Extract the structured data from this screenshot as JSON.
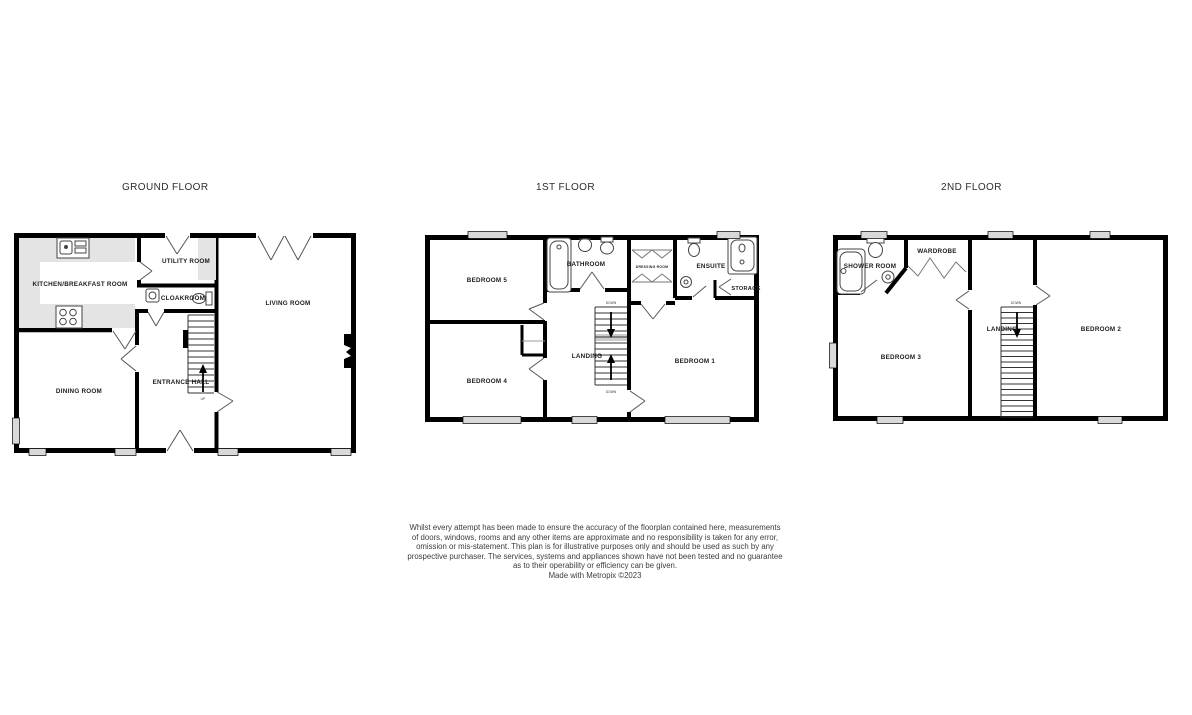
{
  "colors": {
    "wall": "#000000",
    "window_fill": "#d9d9d9",
    "counter_fill": "#e4e4e4",
    "fixture_stroke": "#444444",
    "label_color": "#1c1c1c"
  },
  "floors": [
    {
      "title": "GROUND FLOOR",
      "rooms": [
        {
          "label": "KITCHEN/BREAKFAST ROOM"
        },
        {
          "label": "UTILITY ROOM"
        },
        {
          "label": "CLOAKROOM"
        },
        {
          "label": "LIVING ROOM"
        },
        {
          "label": "DINING ROOM"
        },
        {
          "label": "ENTRANCE HALL"
        }
      ],
      "stair_label": "UP"
    },
    {
      "title": "1ST FLOOR",
      "rooms": [
        {
          "label": "BEDROOM 5"
        },
        {
          "label": "BATHROOM"
        },
        {
          "label": "DRESSING ROOM"
        },
        {
          "label": "ENSUITE"
        },
        {
          "label": "STORAGE"
        },
        {
          "label": "LANDING"
        },
        {
          "label": "BEDROOM 1"
        },
        {
          "label": "BEDROOM 4"
        }
      ],
      "stair_label_top": "DOWN",
      "stair_label_bottom": "DOWN"
    },
    {
      "title": "2ND FLOOR",
      "rooms": [
        {
          "label": "SHOWER ROOM"
        },
        {
          "label": "WARDROBE"
        },
        {
          "label": "BEDROOM 3"
        },
        {
          "label": "LANDING"
        },
        {
          "label": "BEDROOM 2"
        }
      ],
      "stair_label": "DOWN"
    }
  ],
  "disclaimer": {
    "lines": [
      "Whilst every attempt has been made to ensure the accuracy of the floorplan contained here, measurements",
      "of doors, windows, rooms and any other items are approximate and no responsibility is taken for any error,",
      "omission or mis-statement. This plan is for illustrative purposes only and should be used as such by any",
      "prospective purchaser. The services, systems and appliances shown have not been tested and no guarantee",
      "as to their operability or efficiency can be given."
    ],
    "credit": "Made with Metropix ©2023"
  }
}
